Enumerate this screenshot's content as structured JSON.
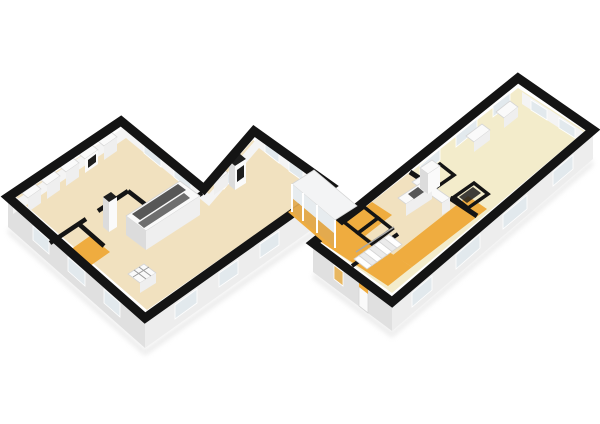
{
  "scene": {
    "type": "3d-floorplan-render",
    "view": "isometric-birdseye",
    "wings": [
      {
        "id": "left-wing",
        "shape": "chevron",
        "rooms": [
          "living-area",
          "middle-room",
          "wc",
          "hallway"
        ],
        "furniture": [
          "wardrobe-row",
          "media-cabinet",
          "kitchen-island",
          "pillar",
          "wood-stove",
          "floor-vent"
        ]
      },
      {
        "id": "glass-bridge",
        "rooms": [
          "corridor"
        ]
      },
      {
        "id": "right-wing",
        "shape": "long-rectangle",
        "rooms": [
          "great-room",
          "kitchen",
          "hallway",
          "closets"
        ],
        "furniture": [
          "l-kitchen-counter",
          "tall-cabinet",
          "staircase",
          "wall-sills"
        ]
      }
    ]
  },
  "colors": {
    "background": "#FFFFFF",
    "wall_top": "#141414",
    "wall_face": "#EDEDED",
    "wall_face_shade": "#E0E0E0",
    "wall_inner": "#F4F4F4",
    "floor_main": "#F1E1BF",
    "floor_cream": "#F3ECCB",
    "floor_accent": "#EFAC3F",
    "window_glass": "#E2E9ED",
    "window_warm": "#E8B761",
    "window_frame": "#FFFFFF",
    "furniture_white": "#FAFAFA",
    "furniture_front": "#EFEFEF",
    "furniture_side": "#DCDCDC",
    "counter_dark": "#575757",
    "counter_dark2": "#6E6E6E",
    "appliance_dark": "#1E1E1E",
    "stair_tread": "#FFFFFF",
    "stair_shade": "#EBEBEB",
    "stair_rail": "#A9A9A9",
    "bridge_roof": "#F3F4F5",
    "bridge_glass": "#E7ECEF",
    "bridge_glass_warm": "#E2A94F",
    "shadow": "#D9D9D9",
    "grid_line": "#9A9A9A",
    "box_stroke": "#D5D5D5"
  }
}
